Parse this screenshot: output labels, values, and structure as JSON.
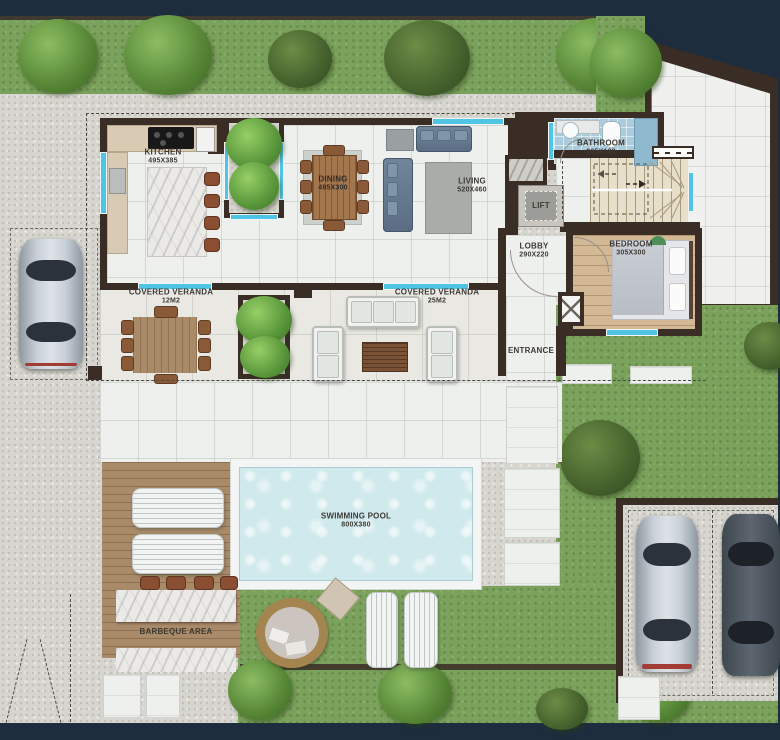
{
  "palette": {
    "frame_navy": "#1e2d3e",
    "wall_dark": "#3a2d25",
    "grass_green": "#7ba25c",
    "gravel": "#d7d5cf",
    "interior_tile": "#eef0ee",
    "pool_water": "#cfe9ec",
    "window_cyan": "#4fc4e4",
    "deck_wood": "#aa8b69",
    "bedroom_wood": "#d2b894",
    "sofa_blue": "#5a6d84"
  },
  "rooms": {
    "kitchen": {
      "name": "KITCHEN",
      "dims": "495X385"
    },
    "dining": {
      "name": "DINING",
      "dims": "495X300"
    },
    "living": {
      "name": "LIVING",
      "dims": "520X460"
    },
    "bathroom": {
      "name": "BATHROOM",
      "dims": "295X120"
    },
    "lift": {
      "name": "LIFT"
    },
    "lobby": {
      "name": "LOBBY",
      "dims": "290X220"
    },
    "bedroom": {
      "name": "BEDROOM",
      "dims": "305X300"
    },
    "veranda_left": {
      "name": "COVERED VERANDA",
      "dims": "12M2"
    },
    "veranda_right": {
      "name": "COVERED VERANDA",
      "dims": "25M2"
    },
    "entrance": {
      "name": "ENTRANCE"
    }
  },
  "outdoor": {
    "pool": {
      "name": "SWIMMING POOL",
      "dims": "800X380"
    },
    "barbeque": {
      "name": "BARBEQUE AREA"
    }
  }
}
